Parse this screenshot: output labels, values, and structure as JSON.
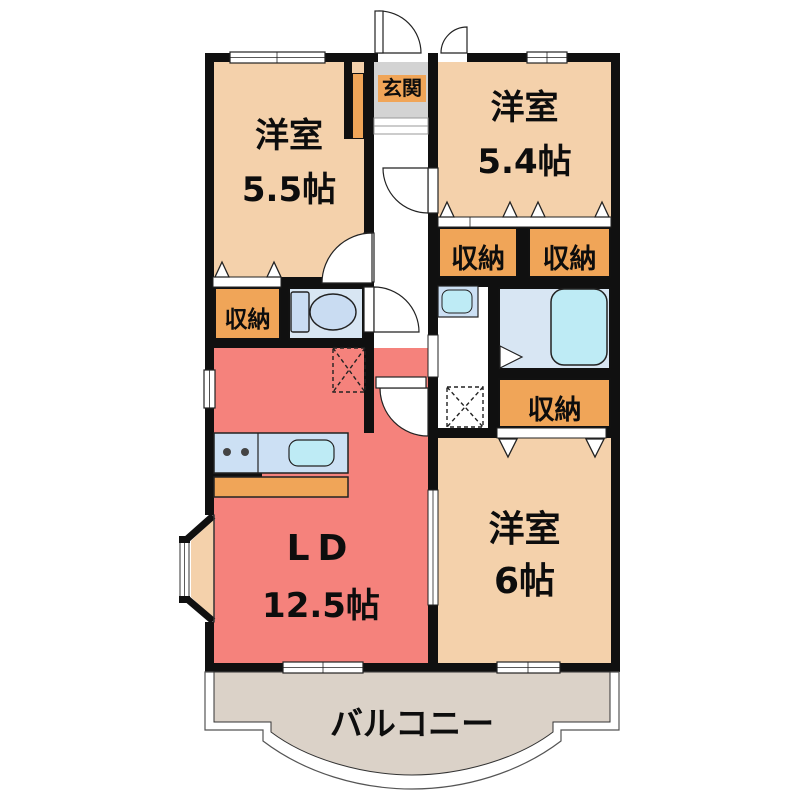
{
  "title": "3LDK apartment floor plan",
  "rooms": {
    "western1": {
      "name": "洋室",
      "size": "5.5帖"
    },
    "western2": {
      "name": "洋室",
      "size": "5.4帖"
    },
    "western3": {
      "name": "洋室",
      "size": "6帖"
    },
    "living_dining": {
      "name": "LD",
      "size": "12.5帖"
    },
    "entrance": {
      "label": "玄関"
    },
    "balcony": {
      "label": "バルコニー"
    }
  },
  "storages": [
    {
      "label": "収納"
    },
    {
      "label": "収納"
    },
    {
      "label": "収納"
    },
    {
      "label": "収納"
    }
  ],
  "fixtures": {
    "toilet": "toilet-icon",
    "bathtub": "bathtub-icon",
    "washbasin": "washbasin-icon",
    "kitchen_sink": "kitchen-sink-icon",
    "stove": "stove-icon",
    "refrigerator_space": "refrigerator-dashed-area",
    "washing_machine_space": "washing-machine-dashed-area"
  },
  "colors": {
    "wall": "#101010",
    "room_beige": "#F4D1AB",
    "storage_orange": "#F0A558",
    "living_red": "#F5827C",
    "entrance_gray": "#D3D3D3",
    "balcony_gray": "#DBD2C8",
    "water_room_blue": "#D8E6F3",
    "counter_blue": "#CCE0F4",
    "fixture_cyan": "#BEEBF5"
  }
}
